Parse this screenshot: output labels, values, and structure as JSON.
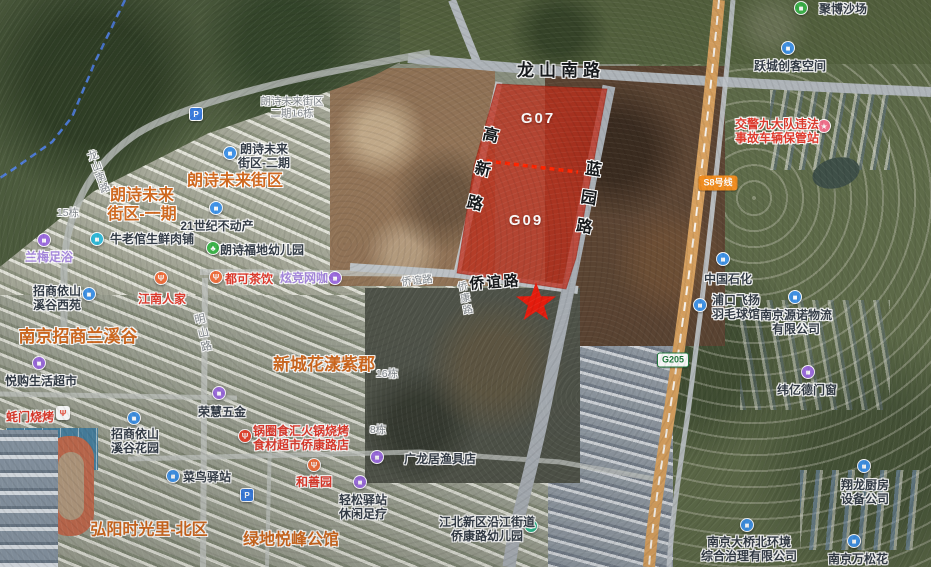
{
  "map": {
    "kind": "satellite-map-with-land-parcel-highlight",
    "colors": {
      "parcel_overlay": "#c2301c",
      "parcel_divider": "#ff2400",
      "star": "#ea1c0d",
      "boundary_dashed": "#4f7fe8",
      "estate_text": "#d2691e"
    },
    "parcel_codes": [
      {
        "text": "G07",
        "x": 538,
        "y": 119
      },
      {
        "text": "G09",
        "x": 526,
        "y": 221
      }
    ],
    "road_labels": [
      {
        "text": "龙山南路",
        "x": 561,
        "y": 71,
        "cls": "road",
        "size": 17,
        "ls": 5
      },
      {
        "text": "高新路",
        "x": 478,
        "y": 177,
        "cls": "road",
        "size": 16,
        "vertical": true,
        "rot": 13,
        "ls": 19
      },
      {
        "text": "蓝园路",
        "x": 585,
        "y": 203,
        "cls": "road",
        "size": 16,
        "vertical": true,
        "rot": 9,
        "ls": 13
      },
      {
        "text": "侨谊路",
        "x": 495,
        "y": 283,
        "cls": "road",
        "size": 15,
        "ls": 2,
        "rot": -4
      },
      {
        "text": "侨谊路",
        "x": 417,
        "y": 281,
        "cls": "minor",
        "size": 10.5,
        "rot": -6
      },
      {
        "text": "侨康路",
        "x": 463,
        "y": 299,
        "cls": "minor",
        "size": 10,
        "vertical": true,
        "rot": -12,
        "ls": 2
      },
      {
        "text": "明山路",
        "x": 202,
        "y": 334,
        "cls": "minor",
        "size": 11,
        "vertical": true,
        "rot": -13,
        "ls": 3
      },
      {
        "text": "龙山南路",
        "x": 98,
        "y": 172,
        "cls": "minor",
        "size": 10.5,
        "vertical": true,
        "rot": -20,
        "ls": 1
      },
      {
        "lines": [
          "朗诗未来街区",
          "二期16栋"
        ],
        "x": 292,
        "y": 108,
        "cls": "minor",
        "size": 10.5
      },
      {
        "text": "15栋",
        "x": 68,
        "y": 213,
        "cls": "minor",
        "size": 10.5
      },
      {
        "text": "16栋",
        "x": 387,
        "y": 374,
        "cls": "minor",
        "size": 10.5
      },
      {
        "text": "8栋",
        "x": 378,
        "y": 430,
        "cls": "minor",
        "size": 10.5
      }
    ],
    "estate_labels": [
      {
        "text": "朗诗未来街区",
        "x": 235,
        "y": 182,
        "size": 16
      },
      {
        "lines": [
          "朗诗未来",
          "街区-一期"
        ],
        "x": 142,
        "y": 206,
        "size": 16
      },
      {
        "text": "南京招商兰溪谷",
        "x": 78,
        "y": 337,
        "size": 17
      },
      {
        "text": "新城花漾紫郡",
        "x": 324,
        "y": 365,
        "size": 17
      },
      {
        "text": "弘阳时光里-北区",
        "x": 149,
        "y": 531,
        "size": 16
      },
      {
        "text": "绿地悦峰公馆",
        "x": 291,
        "y": 541,
        "size": 16
      }
    ],
    "pois": [
      {
        "lines": [
          "聚博沙场"
        ],
        "x": 843,
        "y": 9,
        "cls": "dark",
        "pin": {
          "icon": "building-icon",
          "glyph": "■",
          "color": "#3cb54a",
          "x": 801,
          "y": 8
        }
      },
      {
        "lines": [
          "跃城创客空间"
        ],
        "x": 790,
        "y": 66,
        "cls": "dark",
        "pin": {
          "icon": "building-icon",
          "glyph": "■",
          "color": "#3f93e8",
          "x": 788,
          "y": 48
        }
      },
      {
        "lines": [
          "交警九大队违法",
          "事故车辆保管站"
        ],
        "x": 777,
        "y": 131,
        "cls": "red",
        "pin": {
          "icon": "star-icon",
          "glyph": "★",
          "color": "#f2718c",
          "x": 824,
          "y": 126
        }
      },
      {
        "lines": [
          "中国石化"
        ],
        "x": 728,
        "y": 279,
        "cls": "dark",
        "pin": {
          "icon": "gas-station-icon",
          "glyph": "■",
          "color": "#3f93e8",
          "x": 723,
          "y": 259
        }
      },
      {
        "lines": [
          "浦口飞扬",
          "羽毛球馆"
        ],
        "x": 736,
        "y": 307,
        "cls": "dark",
        "pin": {
          "icon": "badminton-icon",
          "glyph": "■",
          "color": "#3f93e8",
          "x": 700,
          "y": 305
        }
      },
      {
        "lines": [
          "南京源诺物流",
          "有限公司"
        ],
        "x": 796,
        "y": 322,
        "cls": "dark",
        "pin": {
          "icon": "building-icon",
          "glyph": "■",
          "color": "#3f93e8",
          "x": 795,
          "y": 297
        }
      },
      {
        "lines": [
          "纬亿德门窗"
        ],
        "x": 807,
        "y": 390,
        "cls": "dark",
        "pin": {
          "icon": "lock-icon",
          "glyph": "■",
          "color": "#9d6ce0",
          "x": 808,
          "y": 372
        }
      },
      {
        "lines": [
          "翔龙厨房",
          "设备公司"
        ],
        "x": 865,
        "y": 492,
        "cls": "dark",
        "pin": {
          "icon": "building-icon",
          "glyph": "■",
          "color": "#3f93e8",
          "x": 864,
          "y": 466
        }
      },
      {
        "lines": [
          "南京大桥北环境",
          "综合治理有限公司"
        ],
        "x": 749,
        "y": 549,
        "cls": "dark",
        "pin": {
          "icon": "building-icon",
          "glyph": "■",
          "color": "#3f93e8",
          "x": 747,
          "y": 525
        }
      },
      {
        "lines": [
          "南京万松花"
        ],
        "x": 858,
        "y": 559,
        "cls": "dark",
        "pin": {
          "icon": "building-icon",
          "glyph": "■",
          "color": "#3f93e8",
          "x": 854,
          "y": 541
        }
      },
      {
        "lines": [
          "朗诗未来",
          "街区-二期"
        ],
        "x": 264,
        "y": 156,
        "cls": "dark",
        "pin": {
          "icon": "building-icon",
          "glyph": "■",
          "color": "#3f93e8",
          "x": 230,
          "y": 153
        }
      },
      {
        "lines": [
          "21世纪不动产"
        ],
        "x": 217,
        "y": 226,
        "cls": "dark",
        "pin": {
          "icon": "building-icon",
          "glyph": "■",
          "color": "#3f93e8",
          "x": 216,
          "y": 208
        }
      },
      {
        "lines": [
          "牛老倌生鲜肉铺"
        ],
        "x": 152,
        "y": 239,
        "cls": "dark",
        "pin": {
          "icon": "shop-icon",
          "glyph": "■",
          "color": "#2fb9d8",
          "x": 97,
          "y": 239
        }
      },
      {
        "lines": [
          "兰梅足浴"
        ],
        "x": 49,
        "y": 257,
        "cls": "light",
        "pin": {
          "icon": "foot-spa-icon",
          "glyph": "■",
          "color": "#9d6ce0",
          "x": 44,
          "y": 240
        }
      },
      {
        "lines": [
          "朗诗福地幼儿园"
        ],
        "x": 262,
        "y": 250,
        "cls": "dark",
        "pin": {
          "icon": "kindergarten-icon",
          "glyph": "♣",
          "color": "#3cb54a",
          "x": 213,
          "y": 248
        }
      },
      {
        "lines": [
          "都可茶饮"
        ],
        "x": 249,
        "y": 279,
        "cls": "red",
        "pin": {
          "icon": "tea-cup-icon",
          "glyph": "Ψ",
          "color": "#f2703d",
          "x": 216,
          "y": 277
        }
      },
      {
        "lines": [
          "炫竞网咖"
        ],
        "x": 304,
        "y": 278,
        "cls": "light",
        "pin": {
          "icon": "internet-cafe-icon",
          "glyph": "■",
          "color": "#9d6ce0",
          "x": 335,
          "y": 278
        }
      },
      {
        "lines": [
          "江南人家"
        ],
        "x": 162,
        "y": 299,
        "cls": "red",
        "pin": {
          "icon": "restaurant-icon",
          "glyph": "Ψ",
          "color": "#f2703d",
          "x": 161,
          "y": 278
        }
      },
      {
        "lines": [
          "招商依山",
          "溪谷西苑"
        ],
        "x": 57,
        "y": 298,
        "cls": "dark",
        "pin": {
          "icon": "building-icon",
          "glyph": "■",
          "color": "#3f93e8",
          "x": 89,
          "y": 294
        }
      },
      {
        "lines": [
          "悦购生活超市"
        ],
        "x": 41,
        "y": 381,
        "cls": "dark",
        "pin": {
          "icon": "supermarket-icon",
          "glyph": "■",
          "color": "#9d6ce0",
          "x": 39,
          "y": 363
        }
      },
      {
        "lines": [
          "荣慧五金"
        ],
        "x": 222,
        "y": 412,
        "cls": "dark",
        "pin": {
          "icon": "hardware-icon",
          "glyph": "■",
          "color": "#9d6ce0",
          "x": 219,
          "y": 393
        }
      },
      {
        "lines": [
          "蚝门烧烤"
        ],
        "x": 30,
        "y": 417,
        "cls": "red",
        "pin": {
          "icon": "bbq-fork-icon",
          "glyph": "Ψ",
          "color": "#ffffff",
          "glyph_color": "#e8432e",
          "square": true,
          "x": 63,
          "y": 413
        }
      },
      {
        "lines": [
          "招商依山",
          "溪谷花园"
        ],
        "x": 135,
        "y": 441,
        "cls": "dark",
        "pin": {
          "icon": "building-icon",
          "glyph": "■",
          "color": "#3f93e8",
          "x": 134,
          "y": 418
        }
      },
      {
        "lines": [
          "锅圈食汇火锅烧烤",
          "食材超市侨康路店"
        ],
        "x": 301,
        "y": 438,
        "cls": "red",
        "pin": {
          "icon": "hotpot-fork-icon",
          "glyph": "Ψ",
          "color": "#e8432e",
          "x": 245,
          "y": 436
        }
      },
      {
        "lines": [
          "广龙居渔具店"
        ],
        "x": 440,
        "y": 459,
        "cls": "dark",
        "pin": {
          "icon": "fishing-shop-icon",
          "glyph": "■",
          "color": "#9d6ce0",
          "x": 377,
          "y": 457
        }
      },
      {
        "lines": [
          "和善园"
        ],
        "x": 314,
        "y": 482,
        "cls": "red",
        "pin": {
          "icon": "bun-shop-icon",
          "glyph": "Ψ",
          "color": "#f2703d",
          "x": 314,
          "y": 465
        }
      },
      {
        "lines": [
          "菜鸟驿站"
        ],
        "x": 207,
        "y": 477,
        "cls": "dark",
        "pin": {
          "icon": "parcel-station-icon",
          "glyph": "■",
          "color": "#3f93e8",
          "x": 173,
          "y": 476
        }
      },
      {
        "lines": [
          "轻松驿站",
          "休闲足疗"
        ],
        "x": 363,
        "y": 507,
        "cls": "dark",
        "pin": {
          "icon": "foot-spa-icon",
          "glyph": "■",
          "color": "#9d6ce0",
          "x": 360,
          "y": 482
        }
      },
      {
        "lines": [
          "江北新区沿江街道",
          "侨康路幼儿园"
        ],
        "x": 487,
        "y": 529,
        "cls": "dark",
        "pin": {
          "icon": "kindergarten-icon",
          "glyph": "♣",
          "color": "#2eb98d",
          "x": 531,
          "y": 526
        }
      }
    ],
    "standalone_pins": [
      {
        "icon": "parking-icon",
        "glyph": "P",
        "color": "#3a7de0",
        "square": true,
        "x": 196,
        "y": 114
      },
      {
        "icon": "parking-icon",
        "glyph": "P",
        "color": "#3a7de0",
        "square": true,
        "x": 247,
        "y": 495
      }
    ],
    "badges": [
      {
        "name": "metro-line-badge",
        "text": "S8号线",
        "x": 718,
        "y": 183,
        "bg": "#f08c1f",
        "color": "#ffffff",
        "border": "#f08c1f"
      },
      {
        "name": "highway-badge",
        "text": "G205",
        "x": 673,
        "y": 360,
        "bg": "#ffffff",
        "color": "#1e7a3c",
        "border": "#1e7a3c"
      }
    ]
  }
}
